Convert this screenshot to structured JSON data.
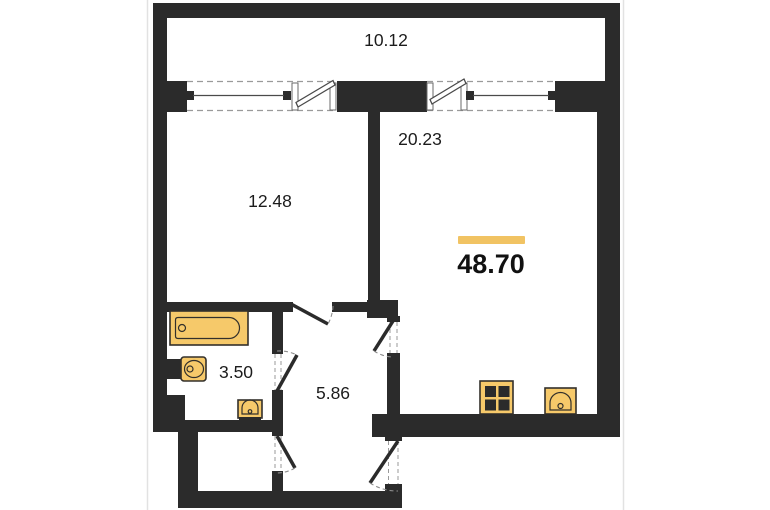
{
  "floorplan": {
    "type": "apartment-floor-plan",
    "total_area": {
      "value": "48.70"
    },
    "rooms": {
      "balcony": {
        "area": "10.12"
      },
      "bedroom": {
        "area": "12.48"
      },
      "living_room": {
        "area": "20.23"
      },
      "bathroom": {
        "area": "3.50"
      },
      "hallway": {
        "area": "5.86"
      }
    },
    "fixtures": [
      "bathtub",
      "toilet",
      "washbasin",
      "stove",
      "kitchen-sink"
    ],
    "colors": {
      "background": "#FFFFFF",
      "wall": "#2B2B2B",
      "fixture_fill": "#F6C96A",
      "fixture_stroke": "#33302B",
      "accent_bar": "#F1C363",
      "dash": "#9A9A9A",
      "text": "#1C1C1C"
    }
  }
}
